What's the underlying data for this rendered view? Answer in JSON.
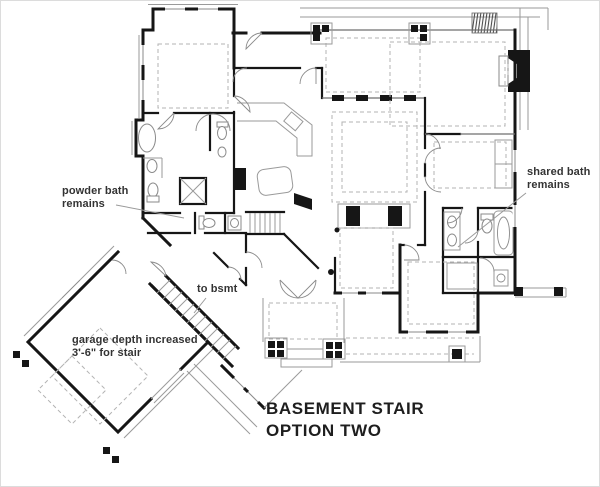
{
  "title": {
    "line1": "BASEMENT STAIR",
    "line2": "OPTION TWO"
  },
  "annotations": {
    "powder_bath": {
      "line1": "powder bath",
      "line2": "remains"
    },
    "shared_bath": {
      "line1": "shared bath",
      "line2": "remains"
    },
    "to_bsmt": {
      "text": "to bsmt"
    },
    "garage_note": {
      "line1": "garage depth increased",
      "line2": "3'-6\" for stair"
    }
  },
  "colors": {
    "wall": "#161616",
    "thin_line": "#9a9a9a",
    "dashed_line": "#b3b3b3",
    "text": "#333333",
    "title_text": "#1e1e1e",
    "background": "#ffffff"
  }
}
